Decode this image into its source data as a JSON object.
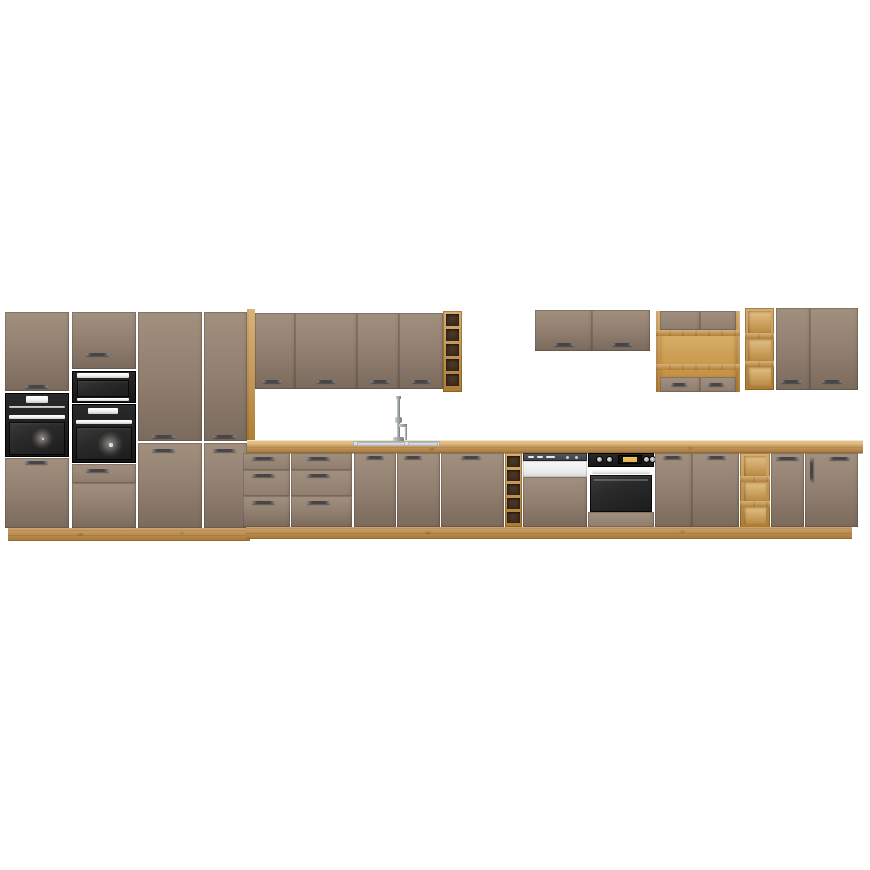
{
  "scene": {
    "description": "Product render of a taupe (cappuccino) and artisan oak kitchen cabinet set on a white background, with built-in black ovens, a compact oven and microwave in tall housings, a sink with chrome mixer tap, a semi-integrated dishwasher, an under-counter oven, open oak shelf units and wine-rack compartments",
    "background_color": "#ffffff"
  },
  "palette": {
    "background": "#ffffff",
    "cabinet": "#8f7d6e",
    "cabinet_light": "#a2907f",
    "cabinet_dark": "#7b6b5d",
    "wood": "#c8913f",
    "wood_light": "#dcae67",
    "wood_dark": "#a87430",
    "wood_face": "#c08a42",
    "counter_top": "#d8b176",
    "rack_dark": "#3a2a1d",
    "appliance_black": "#161616",
    "appliance_glass": "#2a2a2a",
    "trim_white": "#f0efed",
    "display_amber": "#e8b13c",
    "dishwasher_strip": "#3f4144",
    "dishwasher_white": "#ededed",
    "sink_steel": "#d6d9d8",
    "chrome": "#9aa0a3",
    "handle_dark": "#46464a",
    "handle_light": "#8a8a8e"
  },
  "inventory": {
    "tall_cabinet_columns": 4,
    "built_in_ovens_in_tall_columns": 2,
    "compact_appliances_in_tall_columns": 2,
    "left_wall_cabinet_doors": 4,
    "wall_wine_rack_compartments": 5,
    "right_short_wall_cabinet_doors": 2,
    "wall_open_shelf_unit_small_doors": 2,
    "wall_open_rack_compartments": 3,
    "right_tall_wall_cabinet_doors": 2,
    "base_drawer_units": 2,
    "drawers_per_unit": 3,
    "sink_base_doors": 2,
    "base_wine_rack_compartments": 5,
    "dishwasher": "semi-integrated with furniture panel",
    "under_counter_oven": "black with amber display",
    "base_open_shelf_compartments": 3,
    "base_doors": 5
  }
}
